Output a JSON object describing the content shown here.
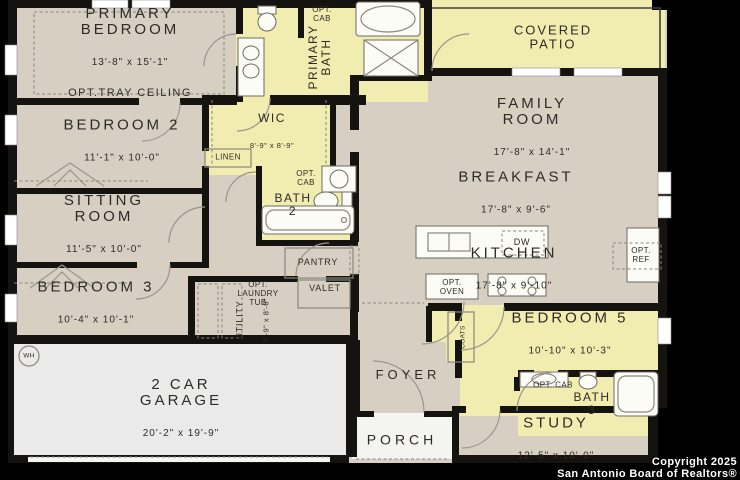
{
  "colors": {
    "bg": "#000000",
    "floor": "#d7cfc2",
    "accent": "#f1edb0",
    "garage": "#eaeaea",
    "porch": "#f4f4f2",
    "wall": "#151310",
    "line": "#8b867e",
    "text": "#2e2a26"
  },
  "rooms": {
    "primary_bedroom": {
      "name": "PRIMARY\nBEDROOM",
      "dims": "13'-8\" x 15'-1\"",
      "note": "OPT.TRAY CEILING"
    },
    "primary_bath": {
      "name": "PRIMARY\nBATH"
    },
    "covered_patio": {
      "name": "COVERED\nPATIO"
    },
    "bedroom_2": {
      "name": "BEDROOM 2",
      "dims": "11'-1\" x 10'-0\""
    },
    "wic": {
      "name": "WIC",
      "dims": "8'-9\" x 8'-9\""
    },
    "sitting_room": {
      "name": "SITTING\nROOM",
      "dims": "11'-5\" x 10'-0\""
    },
    "bedroom_3": {
      "name": "BEDROOM 3",
      "dims": "10'-4\" x 10'-1\""
    },
    "garage": {
      "name": "2 CAR\nGARAGE",
      "dims": "20'-2\" x 19'-9\""
    },
    "family_room": {
      "name": "FAMILY\nROOM",
      "dims": "17'-8\" x 14'-1\""
    },
    "breakfast": {
      "name": "BREAKFAST",
      "dims": "17'-8\" x 9'-6\""
    },
    "kitchen": {
      "name": "KITCHEN",
      "dims": "17'-8\" x 9'-10\""
    },
    "bedroom_5": {
      "name": "BEDROOM 5",
      "dims": "10'-10\" x 10'-3\""
    },
    "bath_2": {
      "name": "BATH\n2"
    },
    "bath_3": {
      "name": "BATH\n3"
    },
    "utility": {
      "name": "UTILITY",
      "dims": "5'-9\" x 8'-6\""
    },
    "study": {
      "name": "STUDY",
      "dims": "12'-5\" x 10'-0\""
    },
    "foyer": {
      "name": "FOYER"
    },
    "porch": {
      "name": "PORCH"
    }
  },
  "labels": {
    "opt_cab_primary": "OPT.\nCAB",
    "opt_cab_bath2": "OPT.\nCAB",
    "opt_cab_bath3": "OPT. CAB",
    "linen": "LINEN",
    "pantry": "PANTRY",
    "valet": "VALET",
    "opt_laundry_tub": "OPT.\nLAUNDRY\nTUB",
    "coats": "COATS",
    "wh": "WH",
    "dw": "DW",
    "opt_ref": "OPT.\nREF",
    "opt_oven": "OPT.\nOVEN"
  },
  "footer": {
    "line1": "Copyright 2025",
    "line2": "San Antonio Board of Realtors®"
  }
}
